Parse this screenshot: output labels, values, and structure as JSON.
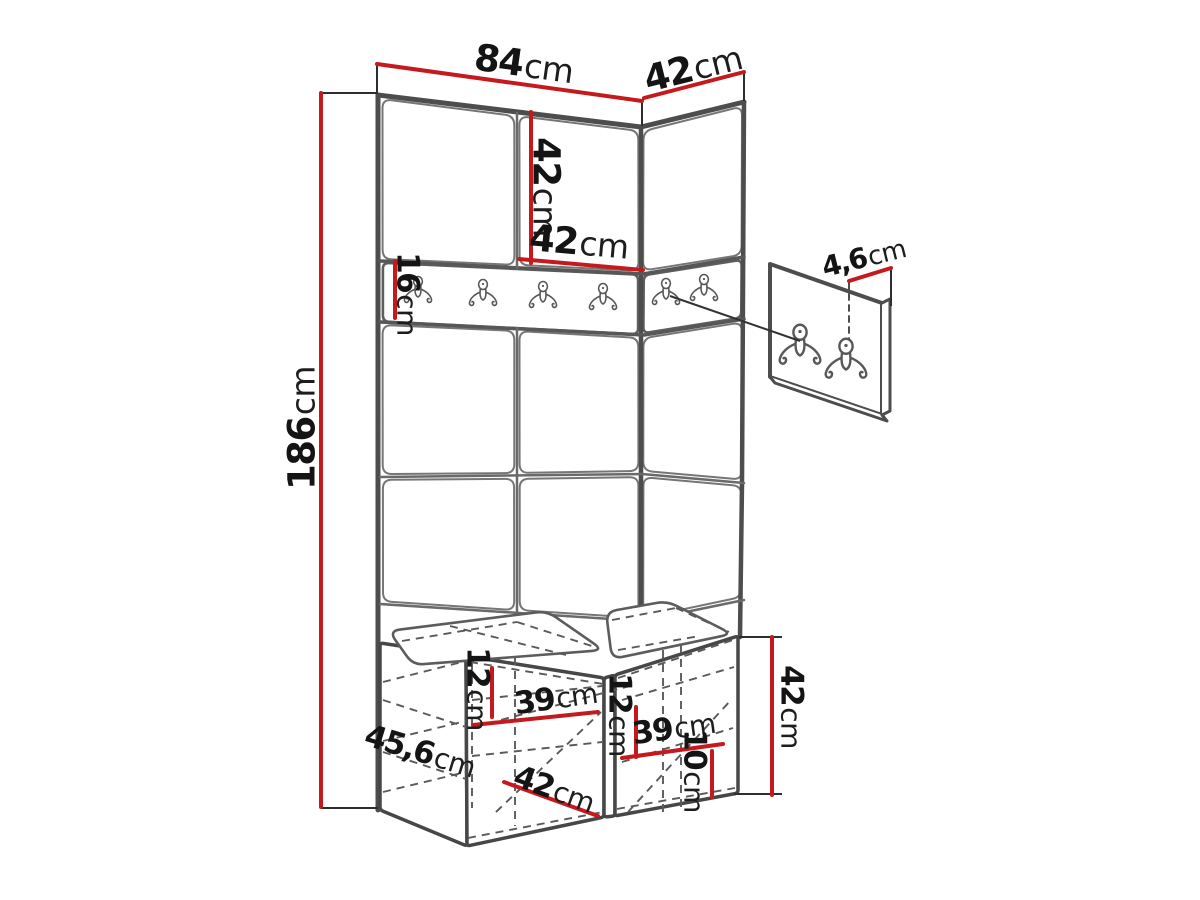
{
  "diagram": {
    "icons": {
      "coat_hook": "double-coat-hook"
    },
    "colors": {
      "dimension": "#c51a1d",
      "outline": "#4d4d4d",
      "text": "#141414",
      "background": "#ffffff"
    },
    "dimensions": {
      "top_width": {
        "value": "84",
        "unit": "cm"
      },
      "top_depth_right": {
        "value": "42",
        "unit": "cm"
      },
      "upper_panel_height": {
        "value": "42",
        "unit": "cm"
      },
      "upper_panel_width": {
        "value": "42",
        "unit": "cm"
      },
      "rail_height": {
        "value": "16",
        "unit": "cm"
      },
      "total_height": {
        "value": "186",
        "unit": "cm"
      },
      "hook_panel_thickness": {
        "value": "4,6",
        "unit": "cm"
      },
      "bench_left_inner_height": {
        "value": "12",
        "unit": "cm"
      },
      "bench_left_inner_width": {
        "value": "39",
        "unit": "cm"
      },
      "bench_depth": {
        "value": "45,6",
        "unit": "cm"
      },
      "bench_left_width": {
        "value": "42",
        "unit": "cm"
      },
      "bench_right_inner_height": {
        "value": "12",
        "unit": "cm"
      },
      "bench_right_inner_width": {
        "value": "39",
        "unit": "cm"
      },
      "bench_bottom_height": {
        "value": "10",
        "unit": "cm"
      },
      "bench_height": {
        "value": "42",
        "unit": "cm"
      }
    }
  }
}
